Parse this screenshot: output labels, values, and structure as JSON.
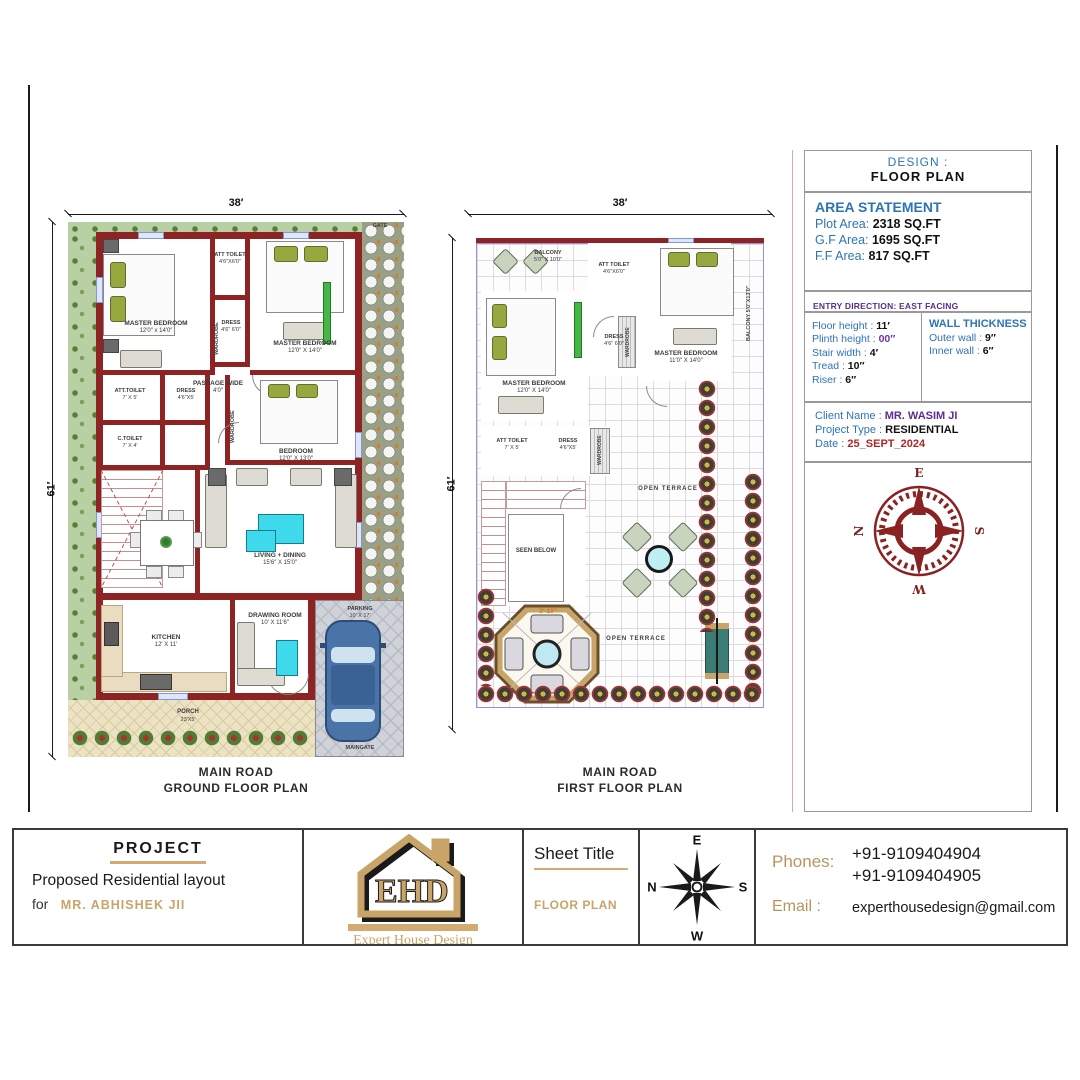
{
  "colors": {
    "wall": "#8e2323",
    "accent_gold": "#c9a469",
    "info_blue": "#2e74b5",
    "info_purple": "#5b2d90",
    "date_red": "#b02525",
    "rose_red": "#8b2222",
    "cyan_furniture": "#3fd9ec"
  },
  "ground_floor": {
    "dim_width": "38′",
    "dim_height": "61′",
    "gate": "GATE",
    "title1": "MAIN ROAD",
    "title2": "GROUND FLOOR PLAN",
    "labels": {
      "master1_name": "MASTER BEDROOM",
      "master1_size": "12′0″ x 14′0″",
      "att1_name": "ATT TOILET",
      "att1_size": "4′6″X6′0″",
      "dress1_name": "DRESS",
      "dress1_size": "4′6″ 6′0″",
      "master2_name": "MASTER BEDROOM",
      "master2_size": "12′0″ X 14′0″",
      "passage_name": "PASSAGE WIDE",
      "passage_size": "4′0″",
      "att2_name": "ATT.TOILET",
      "att2_size": "7′ X 5′",
      "dress2_name": "DRESS",
      "dress2_size": "4′6″X5′",
      "ctoilet_name": "C.TOILET",
      "ctoilet_size": "7′ X 4′",
      "bedroom_name": "BEDROOM",
      "bedroom_size": "12′0″ X 13′0″",
      "living_name": "LIVING + DINING",
      "living_size": "15′6″ X 15′0″",
      "kitchen_name": "KITCHEN",
      "kitchen_size": "12′ X 11′",
      "drawing_name": "DRAWING ROOM",
      "drawing_size": "10′ X 11′6″",
      "parking_name": "PARKING",
      "parking_size": "10′ X 17′",
      "porch_name": "PORCH",
      "porch_size": "23′X5′",
      "maingate": "MAINGATE",
      "wardrobe1": "WARDROBE",
      "wardrobe2": "WARDROBE"
    }
  },
  "first_floor": {
    "dim_width": "38′",
    "dim_height": "61′",
    "title1": "MAIN ROAD",
    "title2": "FIRST FLOOR PLAN",
    "labels": {
      "balcony1_name": "BALCONY",
      "balcony1_size": "5′0″ X 10′0″",
      "att1_name": "ATT TOILET",
      "att1_size": "4′6″X6′0″",
      "dress1_name": "DRESS",
      "dress1_size": "4′6″ 6′0″",
      "master1_name": "MASTER BEDROOM",
      "master1_size": "12′0″ X 14′0″",
      "master2_name": "MASTER BEDROOM",
      "master2_size": "11′0″ X 14′0″",
      "balcony2": "BALCONY 5′0″X13′0″",
      "att2_name": "ATT TOILET",
      "att2_size": "7′ X 5′",
      "dress2_name": "DRESS",
      "dress2_size": "4′6″X5′",
      "wardrobe1": "WARDROBE",
      "wardrobe2": "WARDROBE",
      "seen_below": "SEEN BELOW",
      "stair_dim": "3′-10″",
      "open_terrace_1": "OPEN TERRACE",
      "open_terrace_2": "OPEN TERRACE"
    }
  },
  "right_panel": {
    "design_label": "DESIGN :",
    "design_value": "FLOOR PLAN",
    "area_statement": {
      "title": "AREA STATEMENT",
      "rows": [
        {
          "label": "Plot Area:",
          "value": "2318 SQ.FT"
        },
        {
          "label": "G.F Area:",
          "value": "1695 SQ.FT"
        },
        {
          "label": "F.F Area:",
          "value": "817 SQ.FT"
        }
      ]
    },
    "entry_direction": "ENTRY DIRECTION: EAST FACING",
    "specs": [
      {
        "label": "Floor height :",
        "value": "11′"
      },
      {
        "label": "Plinth height :",
        "value": "00″"
      },
      {
        "label": "Stair width :",
        "value": "4′"
      },
      {
        "label": "Tread :",
        "value": "10″"
      },
      {
        "label": "Riser :",
        "value": "6″"
      }
    ],
    "wall_thickness": {
      "title": "WALL THICKNESS",
      "rows": [
        {
          "label": "Outer wall :",
          "value": "9″"
        },
        {
          "label": "Inner wall :",
          "value": "6″"
        }
      ]
    },
    "client": [
      {
        "label": "Client Name :",
        "value": "MR. WASIM JI",
        "style": "purp"
      },
      {
        "label": "Project Type :",
        "value": "RESIDENTIAL",
        "style": "blk"
      },
      {
        "label": "Date :",
        "value": "25_SEPT_2024",
        "style": "red"
      }
    ],
    "rose": {
      "top": "E",
      "right": "S",
      "bottom": "W",
      "left": "N"
    }
  },
  "title_block": {
    "project": {
      "heading": "PROJECT",
      "line1": "Proposed Residential layout",
      "line2_prefix": "for",
      "line2_name": "MR. ABHISHEK JII"
    },
    "logo": {
      "monogram": "EHD",
      "name": "Expert House Design"
    },
    "sheet": {
      "heading": "Sheet Title",
      "value": "FLOOR PLAN"
    },
    "compass": {
      "top": "E",
      "right": "S",
      "bottom": "W",
      "left": "N"
    },
    "contact": {
      "phones_label": "Phones:",
      "phone1": "+91-9109404904",
      "phone2": "+91-9109404905",
      "email_label": "Email :",
      "email": "experthousedesign@gmail.com"
    }
  }
}
